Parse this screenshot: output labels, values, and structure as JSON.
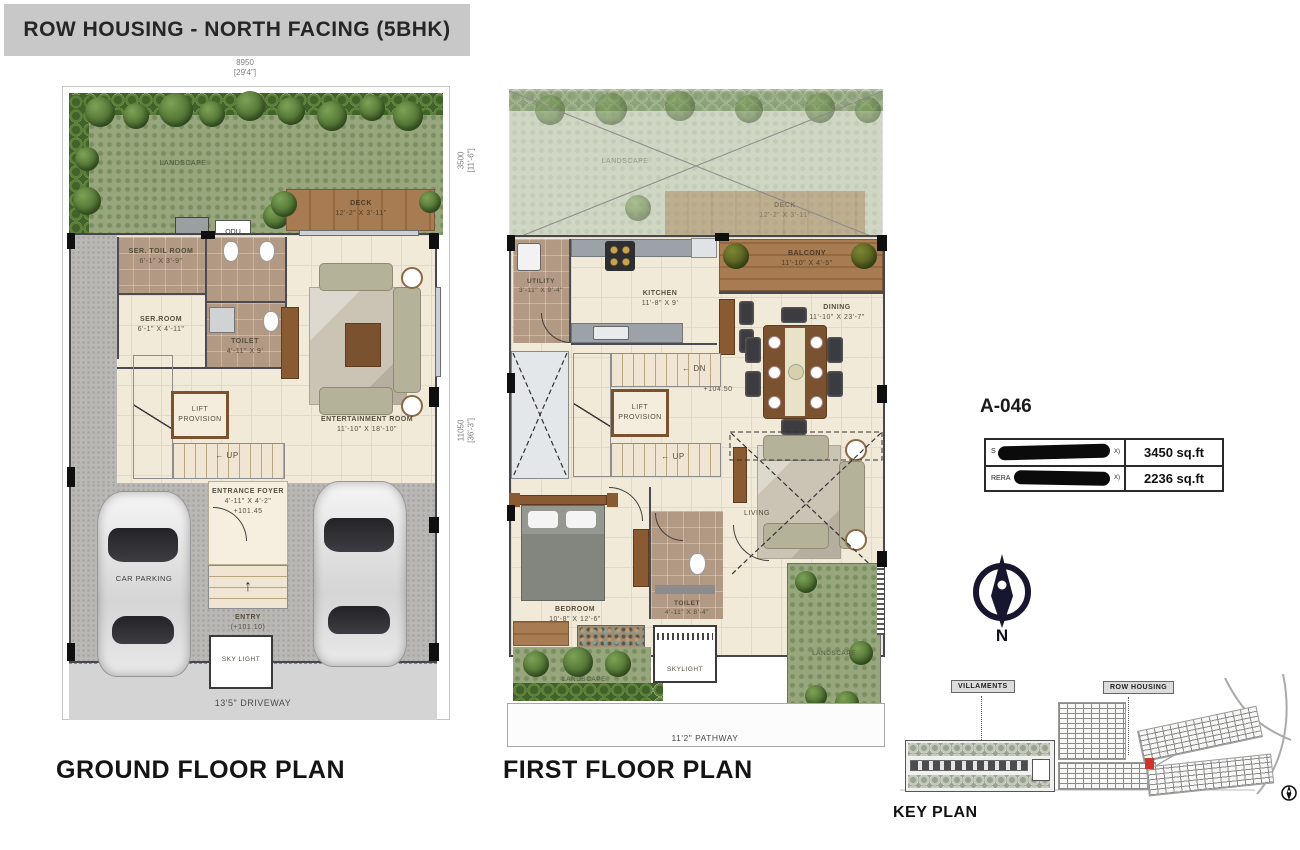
{
  "title": "ROW HOUSING - NORTH FACING (5BHK)",
  "gf": {
    "plan_label": "GROUND FLOOR PLAN",
    "dims": {
      "top_mm": "8950",
      "top_ft": "[29'4\"]",
      "right1_mm": "3500",
      "right1_ft": "[11'-6\"]",
      "right2_mm": "11050",
      "right2_ft": "[36'-3\"]"
    },
    "landscape": "LANDSCAPE",
    "deck": {
      "name": "DECK",
      "dim": "12'-2\" X 3'-11\""
    },
    "odu": "ODU",
    "ser_toil": {
      "name": "SER. TOIL ROOM",
      "dim": "6'-1\" X 3'-9\""
    },
    "ser_room": {
      "name": "SER.ROOM",
      "dim": "6'-1\" X 4'-11\""
    },
    "toilet": {
      "name": "TOILET",
      "dim": "4'-11\" X 9'"
    },
    "lift": "LIFT PROVISION",
    "up": "UP",
    "ent": {
      "name": "ENTERTAINMENT ROOM",
      "dim": "11'-10\" X 18'-10\""
    },
    "foyer": {
      "name": "ENTRANCE FOYER",
      "dim": "4'-11\" X 4'-2\"",
      "level": "+101.45"
    },
    "car": "CAR PARKING",
    "entry": {
      "name": "ENTRY",
      "level": "(+101.10)"
    },
    "skylight": "SKY LIGHT",
    "driveway": "13'5\" DRIVEWAY"
  },
  "ff": {
    "plan_label": "FIRST FLOOR PLAN",
    "landscape": "LANDSCAPE",
    "deck": {
      "name": "DECK",
      "dim": "12'-2\" X 3'-11\""
    },
    "utility": {
      "name": "UTILITY",
      "dim": "3'-11\" X 9'-4\""
    },
    "kitchen": {
      "name": "KITCHEN",
      "dim": "11'-8\" X 9'"
    },
    "balcony": {
      "name": "BALCONY",
      "dim": "11'-10\" X 4'-5\""
    },
    "dining": {
      "name": "DINING",
      "dim": "11'-10\" X 23'-7\""
    },
    "level": "+104.50",
    "lift": "LIFT PROVISION",
    "dn": "DN",
    "up": "UP",
    "bedroom": {
      "name": "BEDROOM",
      "dim": "10'-8\" X 12'-6\""
    },
    "toilet": {
      "name": "TOILET",
      "dim": "4'-11\" X 8'-4\""
    },
    "living": "LIVING",
    "skylight": "SKYLIGHT",
    "landscape2": "LANDSCAPE",
    "landscape3": "LANDSCAPE",
    "pathway": "11'2\" PATHWAY"
  },
  "info": {
    "unit": "A-046",
    "rows": [
      {
        "prefix": "S",
        "suffix": "X)",
        "value": "3450 sq.ft",
        "redacted": true
      },
      {
        "prefix": "RERA",
        "suffix": "X)",
        "value": "2236 sq.ft",
        "redacted": true
      }
    ]
  },
  "compass": {
    "label": "N"
  },
  "kp": {
    "title": "KEY PLAN",
    "villaments": "VILLAMENTS",
    "row_housing": "ROW HOUSING"
  },
  "colors": {
    "accent_red": "#cf3428",
    "wall": "#46464c",
    "floor_cream": "#f2ead9",
    "landscape_green": "#97a67c",
    "deck_brown": "#a87c52",
    "compass_navy": "#16162e",
    "title_bg": "#c8c8c8"
  }
}
